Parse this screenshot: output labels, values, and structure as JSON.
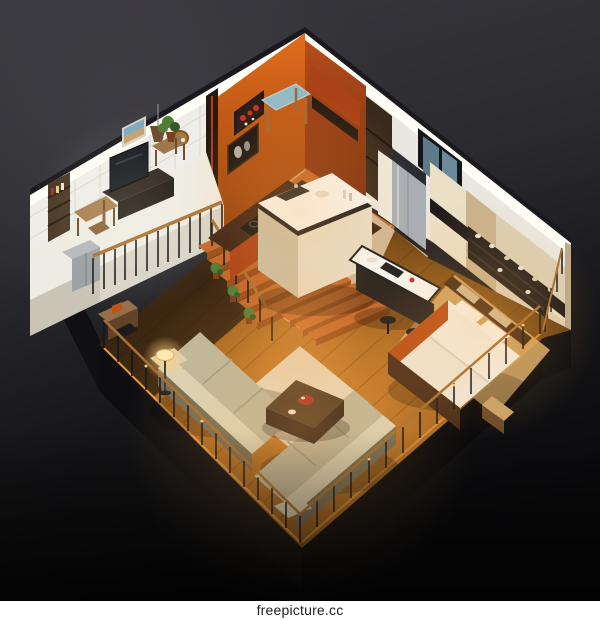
{
  "watermark": {
    "text": "freepicture.cc"
  },
  "palette": {
    "bgA": "#3a393f",
    "bgB": "#2b2a2f",
    "bgMid": "#141416",
    "bgC": "#0a0a0c",
    "bgGlow": "#4a494f",
    "plinth": "#0e0e11",
    "plinthDark": "#09090b",
    "wallTile": "#efede8",
    "tileLine": "#d8d4cc",
    "wallLit": "#fffef7",
    "wallRim": "#1a1a1e",
    "wallWhite": "#eae7e0",
    "orangeHi": "#e26d1e",
    "orangeLo": "#8f3d0b",
    "redWall": "#b44d1b",
    "redWallLo": "#7c2f0e",
    "beigeWall": "#dbcfb5",
    "wardrobeA": "#ebdfc5",
    "wardrobeB": "#c9b28c",
    "wallEnd": "#b9a98c",
    "shelfDark": "#1f1b1a",
    "shelfUnit": "#241f1d",
    "tileHi": "#c2662a",
    "tileLo": "#964a19",
    "grout": "#e6b98b",
    "stone": "#cfb795",
    "woodHi": "#d5842f",
    "woodMid": "#9a5f1d",
    "woodLo": "#5e3a10",
    "floorRim": "#e8963f",
    "rugBed": "#d9ae6c",
    "rugLiving": "#e9e0ca",
    "loftFloor": "#efece3",
    "loftFace": "#d9d4c7",
    "loftFace2": "#c9c4b6",
    "underLoft": "#1a140e",
    "islandTop": "#f8f6f1",
    "islandBand": "#1c1c1f",
    "islandBase": "#e7deca",
    "islandSide": "#c9bfa5",
    "counterTop": "#3c2315",
    "cabOrange": "#ab4218",
    "cooktop": "#131315",
    "tableBlue": "#93bac6",
    "woodFurn": "#9a6a3c",
    "fridge": "#a9aeb4",
    "fridgeDark": "#2b2c32",
    "niche": "#efe9dd",
    "winFrame": "#16161a",
    "glassA": "#5d7a8a",
    "glassB": "#6d8a9a",
    "sofa": "#bdb89e",
    "sofaHi": "#d9d4b8",
    "sofaLo": "#716c58",
    "cTableTop": "#4e3924",
    "cTableSide": "#32231a",
    "trayRed": "#a63120",
    "lampGlow": "#ffcf7e",
    "lampShade": "#ffeab6",
    "poolWarm": "#ffb050",
    "railDark": "#161619",
    "railWood": "#a76f31",
    "bedFrame": "#472a18",
    "bedWhite": "#f3eee5",
    "bedDuvet": "#efe8da",
    "bedPanel": "#cdb795",
    "bedOrange": "#b84c16",
    "benchTan": "#c9a36a",
    "plant": "#4f7d38",
    "plantDark": "#35582a",
    "pot": "#7a3f1c",
    "tv": "#151a1f",
    "tvStand": "#2b231b",
    "desk": "#a87d4d",
    "deskDark": "#6b4a28",
    "bookshelf": "#4a3826",
    "appliance": "#9aa0a4",
    "applianceHi": "#b4b8bc",
    "column": "#241a12",
    "artDark": "#1c1512",
    "posterDark": "#241a16",
    "white": "#ffffff",
    "inkDark": "#1d1d1d"
  }
}
